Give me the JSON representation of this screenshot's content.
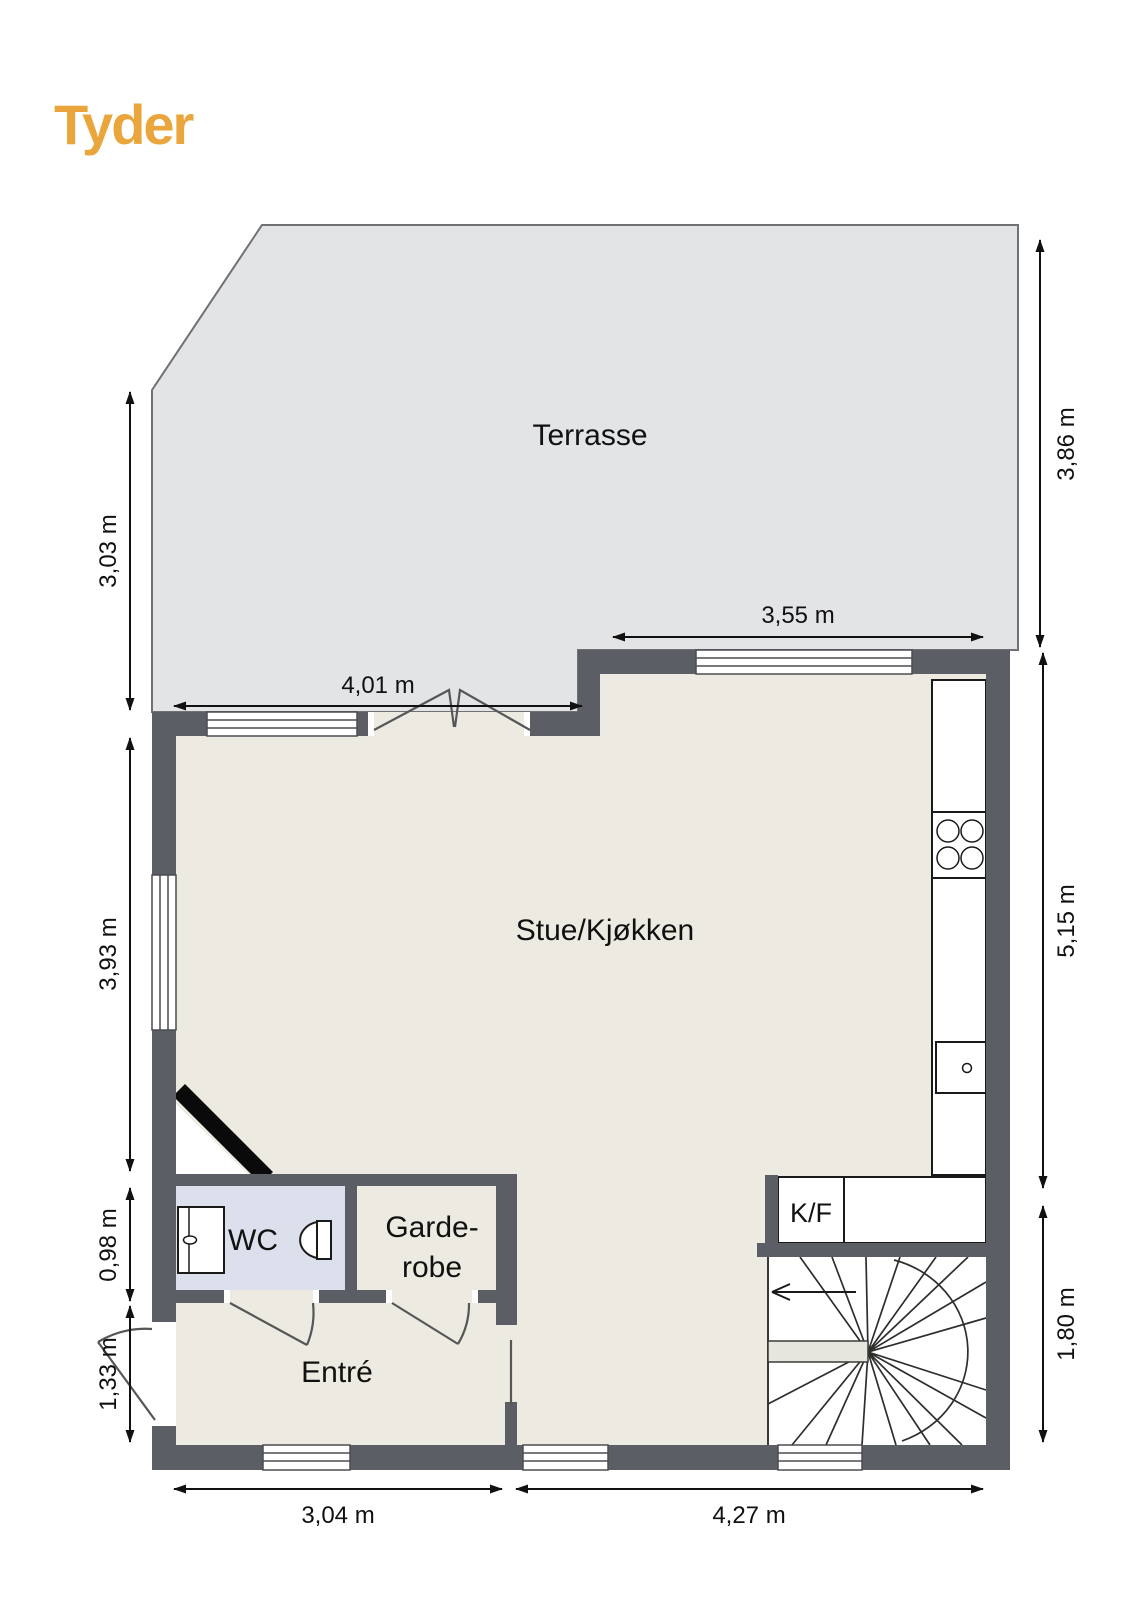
{
  "brand": {
    "logo": "Tyder"
  },
  "colors": {
    "logo": "#EAA63C",
    "wall": "#5B5F65",
    "terrace-floor": "#E3E4E6",
    "interior-floor": "#ECEAE1",
    "wc-floor": "#DBE0EC",
    "fixture-stroke": "#1A1A1A",
    "door-stroke": "#565656",
    "background": "#FFFFFF"
  },
  "rooms": {
    "terrace": {
      "label": "Terrasse"
    },
    "living_kitchen": {
      "label": "Stue/Kjøkken"
    },
    "wc": {
      "label": "WC"
    },
    "wardrobe": {
      "line1": "Garde-",
      "line2": "robe"
    },
    "entry": {
      "label": "Entré"
    },
    "fridge_freezer": {
      "label": "K/F"
    }
  },
  "dimensions": {
    "left_terrace": "3,03 m",
    "left_living": "3,93 m",
    "left_wc": "0,98 m",
    "left_entry": "1,33 m",
    "right_terrace": "3,86 m",
    "right_living": "5,15 m",
    "right_stairs": "1,80 m",
    "top_terrace_door": "4,01 m",
    "top_kitchen_window": "3,55 m",
    "bottom_left": "3,04 m",
    "bottom_right": "4,27 m"
  }
}
